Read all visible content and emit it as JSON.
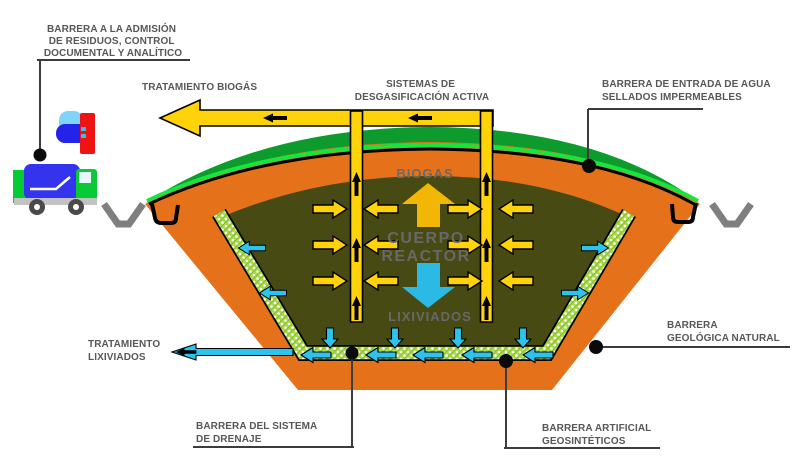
{
  "diagram": {
    "colors": {
      "soil_orange": "#e5721b",
      "waste_olive": "#474a12",
      "cover_green": "#0d9b2d",
      "cover_bright": "#17e53e",
      "liner_green": "#a9d847",
      "pipe_yellow": "#ffd20a",
      "big_arrow_yellow": "#f2b705",
      "cyan": "#2cc4ef",
      "big_arrow_cyan": "#2bb9e6",
      "label_gray": "#575757",
      "center_text": "#686868",
      "channel_gray": "#7f7f7f",
      "truck_blue": "#3434ee",
      "truck_green": "#07cb36",
      "truck_red": "#ee1414",
      "truck_gray": "#c2c2c2",
      "bag_cyan": "#7fd4f7",
      "bag_blue": "#2323ea"
    },
    "labels": {
      "admission": [
        "BARRERA A LA ADMISIÓN",
        "DE RESIDUOS, CONTROL",
        "DOCUMENTAL Y ANALÍTICO"
      ],
      "biogas_treatment": "TRATAMIENTO BIOGÁS",
      "degassing": [
        "SISTEMAS DE",
        "DESGASIFICACIÓN ACTIVA"
      ],
      "water_entry": [
        "BARRERA DE ENTRADA DE AGUA",
        "SELLADOS IMPERMEABLES"
      ],
      "leachate_treatment": [
        "TRATAMIENTO",
        "LIXIVIADOS"
      ],
      "geological": [
        "BARRERA",
        "GEOLÓGICA NATURAL"
      ],
      "drainage": [
        "BARRERA DEL SISTEMA",
        "DE DRENAJE"
      ],
      "geosynthetic": [
        "BARRERA ARTIFICIAL",
        "GEOSINTÉTICOS"
      ]
    },
    "reactor": {
      "biogas": "BIOGAS",
      "body_line1": "CUERPO",
      "body_line2": "REACTOR",
      "leachate": "LIXIVIADOS"
    }
  }
}
